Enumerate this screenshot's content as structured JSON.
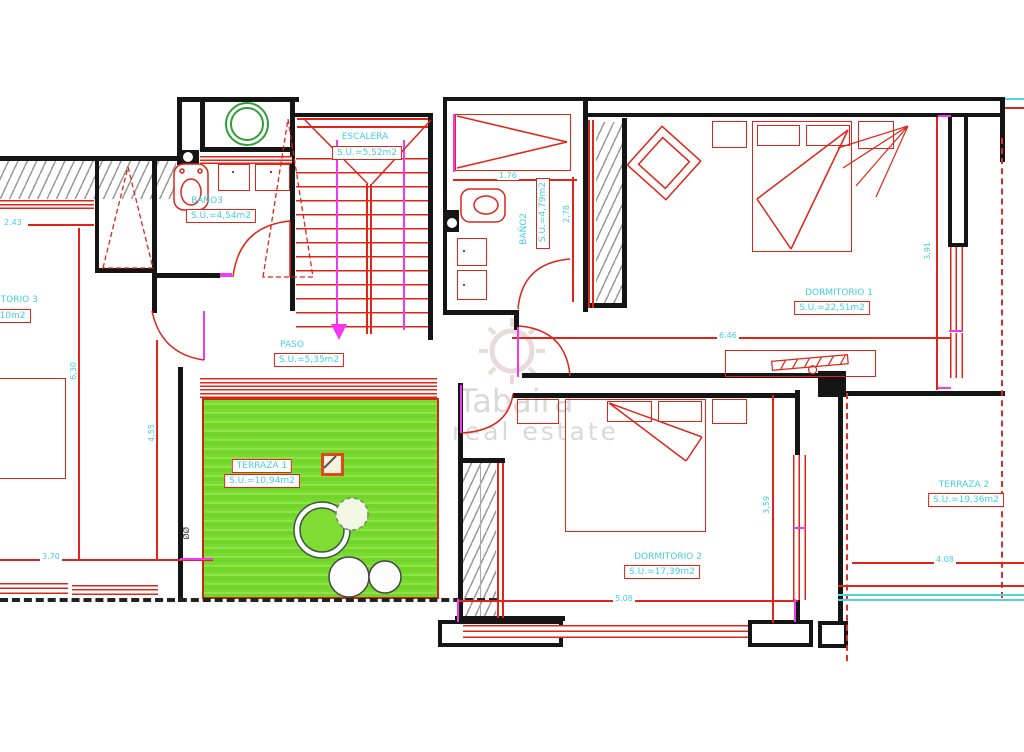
{
  "watermark": {
    "line1": "Tabaira",
    "line2": "real estate"
  },
  "rooms": {
    "escalera": {
      "label": "ESCALERA",
      "area": "S.U.=5,52m2"
    },
    "bano3": {
      "label": "BAÑO3",
      "area": "S.U.=4,54m2"
    },
    "bano2": {
      "label": "BAÑO2",
      "area": "S.U.=4,79m2"
    },
    "dormitorio1": {
      "label": "DORMITORIO 1",
      "area": "S.U.=22,51m2"
    },
    "dormitorio2": {
      "label": "DORMITORIO 2",
      "area": "S.U.=17,39m2"
    },
    "dormitorio3": {
      "label": "DORMITORIO 3",
      "area": "1,10m2"
    },
    "paso": {
      "label": "PASO",
      "area": "S.U.=5,35m2"
    },
    "terraza1": {
      "label": "TERRAZA 1",
      "area": "S.U.=10,94m2"
    },
    "terraza2": {
      "label": "TERRAZA 2",
      "area": "S.U.=19,36m2"
    }
  },
  "dimensions": {
    "d243": "2.43",
    "d176": "1.76",
    "d278": "2,78",
    "d391": "3,91",
    "d646": "6.46",
    "d630": "6,30",
    "d455": "4,55",
    "d370": "3.70",
    "d508": "5.08",
    "d359": "3,59",
    "d408": "4.08"
  },
  "symbols": {
    "diameter": "ØØ"
  }
}
